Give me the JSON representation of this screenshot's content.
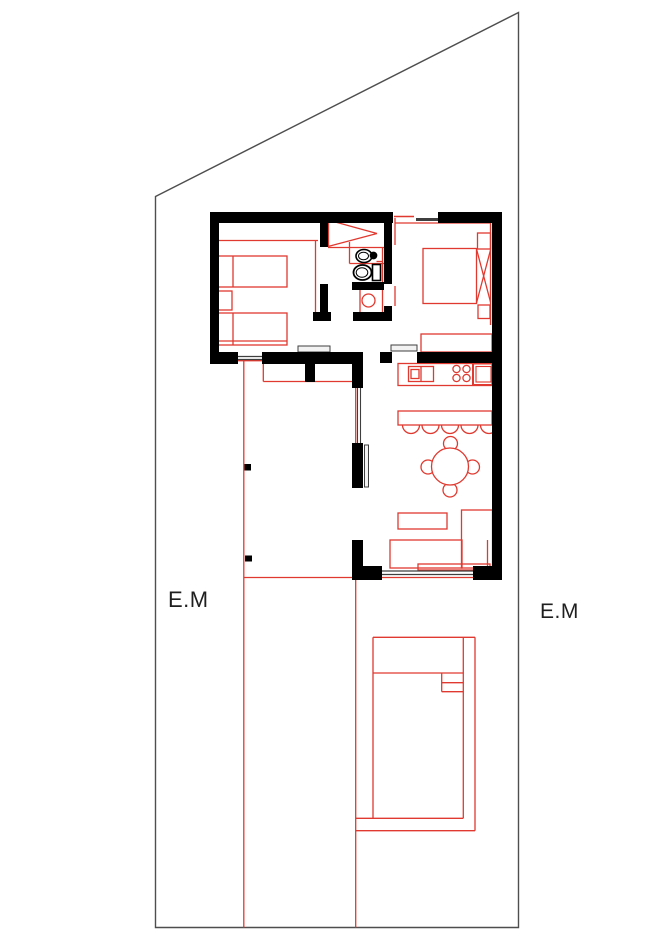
{
  "canvas": {
    "w": 671,
    "h": 950,
    "bg": "#ffffff"
  },
  "colors": {
    "wall": "#000000",
    "red": "#e0392f",
    "gray": "#3f3f3f",
    "leaf_fill": "#f2f2f2",
    "boundary": "#4e4e4e",
    "white": "#ffffff",
    "text": "#1f1f1f"
  },
  "labels": {
    "left": {
      "text": "E.M",
      "x": 168,
      "y": 587,
      "size": 22
    },
    "right": {
      "text": "E.M",
      "x": 540,
      "y": 600,
      "size": 21
    }
  },
  "boundary": {
    "name": "property-boundary",
    "points": "155.5,196.5 518.5,12.5 518.5,927.5 155.5,927.5"
  },
  "shapes": [
    {
      "name": "bedroom1-shelf-line",
      "kind": "line",
      "p": [
        218,
        240.5,
        318,
        240.5
      ],
      "stroke": "red"
    },
    {
      "name": "bedroom1-wardrobe-line",
      "kind": "line",
      "p": [
        315.5,
        241,
        315.5,
        315
      ],
      "stroke": "red"
    },
    {
      "name": "bed-1",
      "kind": "rect",
      "p": [
        217,
        256,
        70,
        31
      ],
      "stroke": "red"
    },
    {
      "name": "bed-1-pillow-line",
      "kind": "line",
      "p": [
        233,
        256,
        233,
        287
      ],
      "stroke": "red"
    },
    {
      "name": "nightstand-1",
      "kind": "rect",
      "p": [
        218,
        291,
        14,
        19
      ],
      "stroke": "red"
    },
    {
      "name": "bed-2",
      "kind": "rect",
      "p": [
        217,
        313,
        70,
        32
      ],
      "stroke": "red"
    },
    {
      "name": "bed-2-pillow-line",
      "kind": "line",
      "p": [
        233,
        313,
        233,
        345
      ],
      "stroke": "red"
    },
    {
      "name": "bed-2-blanket-line",
      "kind": "line",
      "p": [
        217,
        341,
        287,
        341
      ],
      "stroke": "red"
    },
    {
      "name": "closet-rod-line-a",
      "kind": "line",
      "p": [
        328,
        220,
        377,
        233.5
      ],
      "stroke": "red"
    },
    {
      "name": "closet-rod-line-b",
      "kind": "line",
      "p": [
        328,
        246.5,
        377,
        233.5
      ],
      "stroke": "red"
    },
    {
      "name": "closet-rod-base",
      "kind": "line",
      "p": [
        328.5,
        220,
        328.5,
        246.5
      ],
      "stroke": "red"
    },
    {
      "name": "closet-front-line",
      "kind": "line",
      "p": [
        328,
        247.5,
        384,
        247.5
      ],
      "stroke": "red"
    },
    {
      "name": "bath-east-red-line",
      "kind": "line",
      "p": [
        382.5,
        248,
        382.5,
        315
      ],
      "stroke": "red"
    },
    {
      "name": "bedroom2-door-red-a",
      "kind": "line",
      "p": [
        395,
        218,
        395,
        245
      ],
      "stroke": "red"
    },
    {
      "name": "bedroom2-door-red-b",
      "kind": "line",
      "p": [
        395,
        286,
        395,
        306
      ],
      "stroke": "red"
    },
    {
      "name": "bath-counter-left-line",
      "kind": "line",
      "p": [
        349.5,
        242,
        349.5,
        263.5
      ],
      "stroke": "red"
    },
    {
      "name": "bath-counter-bottom-line",
      "kind": "line",
      "p": [
        349.5,
        263.5,
        384,
        263.5
      ],
      "stroke": "red"
    },
    {
      "name": "tank-tick-top",
      "kind": "line",
      "p": [
        376.5,
        261.5,
        383,
        261.5
      ],
      "stroke": "red"
    },
    {
      "name": "tank-tick-bottom",
      "kind": "line",
      "p": [
        376.5,
        283,
        383,
        283
      ],
      "stroke": "red"
    },
    {
      "name": "shower-enclosure-line",
      "kind": "line",
      "p": [
        360,
        290,
        360,
        316
      ],
      "stroke": "red"
    },
    {
      "name": "shower-drain",
      "kind": "circle",
      "p": [
        368.5,
        300.5,
        6.5
      ],
      "stroke": "red"
    },
    {
      "name": "bedroom2-curtain-line",
      "kind": "line",
      "p": [
        395,
        223,
        490.5,
        223
      ],
      "stroke": "red"
    },
    {
      "name": "bedroom2-right-line",
      "kind": "line",
      "p": [
        490.5,
        223,
        490.5,
        325
      ],
      "stroke": "red"
    },
    {
      "name": "double-bed",
      "kind": "rect",
      "p": [
        423,
        248.5,
        53.5,
        55
      ],
      "stroke": "red"
    },
    {
      "name": "double-bed-diagonal-a",
      "kind": "line",
      "p": [
        476.5,
        249,
        490.5,
        302
      ],
      "stroke": "red"
    },
    {
      "name": "double-bed-diagonal-b",
      "kind": "line",
      "p": [
        476.5,
        303,
        490.5,
        250
      ],
      "stroke": "red"
    },
    {
      "name": "nightstand-2",
      "kind": "rect",
      "p": [
        477.5,
        233,
        13,
        16
      ],
      "stroke": "red"
    },
    {
      "name": "nightstand-3",
      "kind": "rect",
      "p": [
        478,
        305,
        12,
        13.5
      ],
      "stroke": "red"
    },
    {
      "name": "bedroom2-cabinet",
      "kind": "rect",
      "p": [
        421,
        334,
        71,
        18
      ],
      "stroke": "red"
    },
    {
      "name": "kitchen-counter",
      "kind": "rect",
      "p": [
        398,
        363.5,
        94,
        22
      ],
      "stroke": "red"
    },
    {
      "name": "kitchen-appliance",
      "kind": "rect",
      "p": [
        408.5,
        366.5,
        25,
        15
      ],
      "stroke": "red"
    },
    {
      "name": "kitchen-appliance-divider",
      "kind": "line",
      "p": [
        421,
        366.5,
        421,
        381.5
      ],
      "stroke": "red"
    },
    {
      "name": "kitchen-appliance-inner",
      "kind": "rect",
      "p": [
        411,
        369.5,
        8,
        9
      ],
      "stroke": "red"
    },
    {
      "name": "burner-1",
      "kind": "circle",
      "p": [
        456.5,
        369,
        3.6
      ],
      "stroke": "red"
    },
    {
      "name": "burner-2",
      "kind": "circle",
      "p": [
        466.5,
        369,
        3.6
      ],
      "stroke": "red"
    },
    {
      "name": "burner-3",
      "kind": "circle",
      "p": [
        456.5,
        378,
        3.6
      ],
      "stroke": "red"
    },
    {
      "name": "burner-4",
      "kind": "circle",
      "p": [
        466.5,
        378,
        3.6
      ],
      "stroke": "red"
    },
    {
      "name": "kitchen-sink",
      "kind": "rect",
      "p": [
        473,
        363.5,
        21,
        21.5
      ],
      "stroke": "red",
      "sw": 2
    },
    {
      "name": "kitchen-sink-inner",
      "kind": "rect",
      "p": [
        476,
        366.5,
        15,
        15.5
      ],
      "stroke": "red",
      "sw": 1.1
    },
    {
      "name": "bar-counter",
      "kind": "rect",
      "p": [
        398,
        411,
        94,
        14
      ],
      "stroke": "red"
    },
    {
      "name": "bar-stool-1",
      "kind": "stool",
      "p": [
        411,
        425,
        8.5
      ],
      "stroke": "red"
    },
    {
      "name": "bar-stool-2",
      "kind": "stool",
      "p": [
        430.5,
        425,
        8.5
      ],
      "stroke": "red"
    },
    {
      "name": "bar-stool-3",
      "kind": "stool",
      "p": [
        450,
        425,
        8.5
      ],
      "stroke": "red"
    },
    {
      "name": "bar-stool-4",
      "kind": "stool",
      "p": [
        469.5,
        425,
        8.5
      ],
      "stroke": "red"
    },
    {
      "name": "bar-stool-5",
      "kind": "stool",
      "p": [
        489,
        425,
        8.5
      ],
      "stroke": "red"
    },
    {
      "name": "dining-chair-top",
      "kind": "circle",
      "p": [
        450.5,
        443.5,
        7
      ],
      "stroke": "red",
      "fill": "white"
    },
    {
      "name": "dining-chair-bottom",
      "kind": "circle",
      "p": [
        450,
        490,
        7
      ],
      "stroke": "red",
      "fill": "white"
    },
    {
      "name": "dining-chair-left",
      "kind": "circle",
      "p": [
        428,
        467,
        7
      ],
      "stroke": "red",
      "fill": "white"
    },
    {
      "name": "dining-chair-right",
      "kind": "circle",
      "p": [
        472.5,
        467,
        7
      ],
      "stroke": "red",
      "fill": "white"
    },
    {
      "name": "dining-table",
      "kind": "circle",
      "p": [
        450,
        466.5,
        18.5
      ],
      "stroke": "red",
      "fill": "white"
    },
    {
      "name": "tv-stand",
      "kind": "rect",
      "p": [
        398,
        513,
        49,
        16
      ],
      "stroke": "red"
    },
    {
      "name": "sofa-main",
      "kind": "rect",
      "p": [
        390,
        540,
        72,
        28
      ],
      "stroke": "red"
    },
    {
      "name": "sofa-chaise",
      "kind": "rect",
      "p": [
        461.5,
        510,
        31,
        58
      ],
      "stroke": "red"
    },
    {
      "name": "sofa-arm-line",
      "kind": "line",
      "p": [
        487.5,
        540,
        487.5,
        568
      ],
      "stroke": "red"
    },
    {
      "name": "sofa-back-rect",
      "kind": "rect",
      "p": [
        418,
        564,
        72,
        6
      ],
      "stroke": "red"
    },
    {
      "name": "terrace-edge-line",
      "kind": "line",
      "p": [
        243.8,
        361,
        243.8,
        927.5
      ],
      "stroke": "red"
    },
    {
      "name": "patio-edge-line",
      "kind": "line",
      "p": [
        355.7,
        578,
        355.7,
        927.5
      ],
      "stroke": "red"
    },
    {
      "name": "west-window-sill-line",
      "kind": "line",
      "p": [
        355.7,
        363,
        355.7,
        443
      ],
      "stroke": "red"
    },
    {
      "name": "alcove-left-line",
      "kind": "line",
      "p": [
        263.3,
        363,
        263.3,
        381.5
      ],
      "stroke": "red"
    },
    {
      "name": "alcove-bottom-line",
      "kind": "line",
      "p": [
        263.3,
        381.5,
        355.5,
        381.5
      ],
      "stroke": "red"
    },
    {
      "name": "terrace-door-sill-line",
      "kind": "line",
      "p": [
        218,
        360.7,
        262,
        360.7
      ],
      "stroke": "red"
    },
    {
      "name": "terrace-horizontal-line",
      "kind": "line",
      "p": [
        243.8,
        577.5,
        501,
        577.5
      ],
      "stroke": "red"
    },
    {
      "name": "top-window-red-pane",
      "kind": "line",
      "p": [
        394,
        216.5,
        414,
        216.5
      ],
      "stroke": "red",
      "sw": 1.5
    },
    {
      "name": "pool-top-edge",
      "kind": "line",
      "p": [
        373,
        637.3,
        475,
        637.3
      ],
      "stroke": "red"
    },
    {
      "name": "pool-left-edge",
      "kind": "line",
      "p": [
        373,
        637.3,
        373,
        818.3
      ],
      "stroke": "red"
    },
    {
      "name": "pool-right-inner-edge",
      "kind": "line",
      "p": [
        463.3,
        637.3,
        463.3,
        818.3
      ],
      "stroke": "red"
    },
    {
      "name": "pool-right-outer-edge",
      "kind": "line",
      "p": [
        475,
        637.3,
        475,
        830.7
      ],
      "stroke": "red"
    },
    {
      "name": "pool-bottom-inner-edge",
      "kind": "line",
      "p": [
        356,
        818.3,
        463.3,
        818.3
      ],
      "stroke": "red"
    },
    {
      "name": "pool-bottom-outer-edge",
      "kind": "line",
      "p": [
        356,
        830.7,
        475,
        830.7
      ],
      "stroke": "red"
    },
    {
      "name": "pool-shallow-divider",
      "kind": "line",
      "p": [
        373,
        673,
        463.3,
        673
      ],
      "stroke": "red"
    },
    {
      "name": "pool-steps-side",
      "kind": "line",
      "p": [
        441.7,
        673,
        441.7,
        691.7
      ],
      "stroke": "red"
    },
    {
      "name": "pool-step-1",
      "kind": "line",
      "p": [
        441.7,
        682.7,
        463.3,
        682.7
      ],
      "stroke": "red"
    },
    {
      "name": "pool-step-2",
      "kind": "line",
      "p": [
        441.7,
        691.7,
        463.3,
        691.7
      ],
      "stroke": "red"
    },
    {
      "name": "bedroom1-door-leaf",
      "kind": "rect",
      "p": [
        298,
        346,
        32,
        6
      ],
      "stroke": "gray",
      "sw": 1,
      "fill": "leaf_fill"
    },
    {
      "name": "bedroom2-door-leaf",
      "kind": "rect",
      "p": [
        391,
        345,
        26,
        6
      ],
      "stroke": "gray",
      "sw": 1,
      "fill": "leaf_fill"
    },
    {
      "name": "terrace-door-threshold-a",
      "kind": "line",
      "p": [
        238,
        356.5,
        262,
        356.5
      ],
      "stroke": "gray",
      "sw": 1.2
    },
    {
      "name": "terrace-door-threshold-b",
      "kind": "line",
      "p": [
        238,
        359.5,
        262,
        359.5
      ],
      "stroke": "gray",
      "sw": 1.2
    },
    {
      "name": "top-window-gray-pane",
      "kind": "line",
      "p": [
        416,
        219.5,
        438,
        219.5
      ],
      "stroke": "gray",
      "sw": 3
    },
    {
      "name": "west-window-pane-a",
      "kind": "line",
      "p": [
        357.5,
        388,
        357.5,
        443
      ],
      "stroke": "gray",
      "sw": 1.1
    },
    {
      "name": "west-window-pane-b",
      "kind": "line",
      "p": [
        360.5,
        388,
        360.5,
        443
      ],
      "stroke": "gray",
      "sw": 1.1
    },
    {
      "name": "living-door-leaf",
      "kind": "rect",
      "p": [
        364.5,
        445,
        4,
        42
      ],
      "stroke": "gray",
      "sw": 1,
      "fill": "leaf_fill"
    },
    {
      "name": "glass-door-track-a",
      "kind": "line",
      "p": [
        382,
        571,
        473,
        571
      ],
      "stroke": "gray",
      "sw": 1.2
    },
    {
      "name": "glass-door-track-b",
      "kind": "line",
      "p": [
        382,
        574.5,
        473,
        574.5
      ],
      "stroke": "gray",
      "sw": 1.2
    },
    {
      "name": "wall-top-left",
      "kind": "wall",
      "p": [
        210,
        212,
        183,
        11
      ]
    },
    {
      "name": "wall-top-right",
      "kind": "wall",
      "p": [
        438,
        212,
        64,
        11
      ]
    },
    {
      "name": "wall-west",
      "kind": "wall",
      "p": [
        210,
        212,
        9,
        151
      ]
    },
    {
      "name": "wall-east",
      "kind": "wall",
      "p": [
        492,
        212,
        10,
        368
      ]
    },
    {
      "name": "wall-south-bedroom1-a",
      "kind": "wall",
      "p": [
        210,
        352,
        28,
        12
      ]
    },
    {
      "name": "wall-south-bedroom1-b",
      "kind": "wall",
      "p": [
        262,
        352,
        101,
        12
      ]
    },
    {
      "name": "wall-kitchen-north-a",
      "kind": "wall",
      "p": [
        380,
        352,
        12,
        11
      ]
    },
    {
      "name": "wall-kitchen-north-b",
      "kind": "wall",
      "p": [
        417,
        352,
        85,
        11
      ]
    },
    {
      "name": "wall-living-west-1",
      "kind": "wall",
      "p": [
        352,
        352,
        11,
        36
      ]
    },
    {
      "name": "wall-living-west-2",
      "kind": "wall",
      "p": [
        352,
        443,
        11,
        45
      ]
    },
    {
      "name": "wall-living-west-3",
      "kind": "wall",
      "p": [
        352,
        540,
        11,
        40
      ]
    },
    {
      "name": "wall-bottom-left",
      "kind": "wall",
      "p": [
        352,
        566,
        30,
        14
      ]
    },
    {
      "name": "wall-bottom-right",
      "kind": "wall",
      "p": [
        473,
        566,
        29,
        14
      ]
    },
    {
      "name": "wall-bath-west-upper",
      "kind": "wall",
      "p": [
        320,
        212,
        8,
        35
      ]
    },
    {
      "name": "wall-bath-west-lower",
      "kind": "wall",
      "p": [
        320,
        284,
        8,
        37
      ]
    },
    {
      "name": "wall-bath-east-upper",
      "kind": "wall",
      "p": [
        384,
        212,
        8,
        72
      ]
    },
    {
      "name": "wall-bath-east-lower",
      "kind": "wall",
      "p": [
        384,
        306,
        8,
        15
      ]
    },
    {
      "name": "wall-bath-south-left",
      "kind": "wall",
      "p": [
        313,
        312,
        18,
        9
      ]
    },
    {
      "name": "wall-bath-south-right",
      "kind": "wall",
      "p": [
        353,
        312,
        39,
        9
      ]
    },
    {
      "name": "wall-shower-north",
      "kind": "wall",
      "p": [
        352,
        282,
        32,
        8
      ]
    },
    {
      "name": "wall-alcove-stub",
      "kind": "wall",
      "p": [
        305,
        352,
        10,
        30
      ]
    },
    {
      "name": "terrace-column-1",
      "kind": "wall",
      "p": [
        244.5,
        464,
        6.5,
        6.5
      ]
    },
    {
      "name": "terrace-column-2",
      "kind": "wall",
      "p": [
        245,
        555.5,
        7,
        6
      ]
    },
    {
      "name": "sink-bowl",
      "kind": "ellipse",
      "p": [
        364,
        256,
        8,
        6.5
      ],
      "stroke": "wall",
      "sw": 1.6
    },
    {
      "name": "sink-bowl-inner",
      "kind": "ellipse",
      "p": [
        363.5,
        256,
        5,
        3.8
      ],
      "stroke": "wall",
      "sw": 1
    },
    {
      "name": "sink-tap",
      "kind": "circle",
      "p": [
        373.5,
        255.5,
        3.2
      ],
      "stroke": "wall",
      "fill": "wall"
    },
    {
      "name": "toilet-bowl",
      "kind": "ellipse",
      "p": [
        362.5,
        272.5,
        9,
        7.5
      ],
      "stroke": "wall",
      "sw": 1.8
    },
    {
      "name": "toilet-bowl-inner",
      "kind": "ellipse",
      "p": [
        362,
        272.5,
        5.8,
        4.8
      ],
      "stroke": "wall",
      "sw": 1
    },
    {
      "name": "toilet-tank",
      "kind": "rect",
      "p": [
        372.5,
        264.5,
        8,
        16
      ],
      "stroke": "wall",
      "sw": 1.6,
      "fill": "white"
    }
  ]
}
